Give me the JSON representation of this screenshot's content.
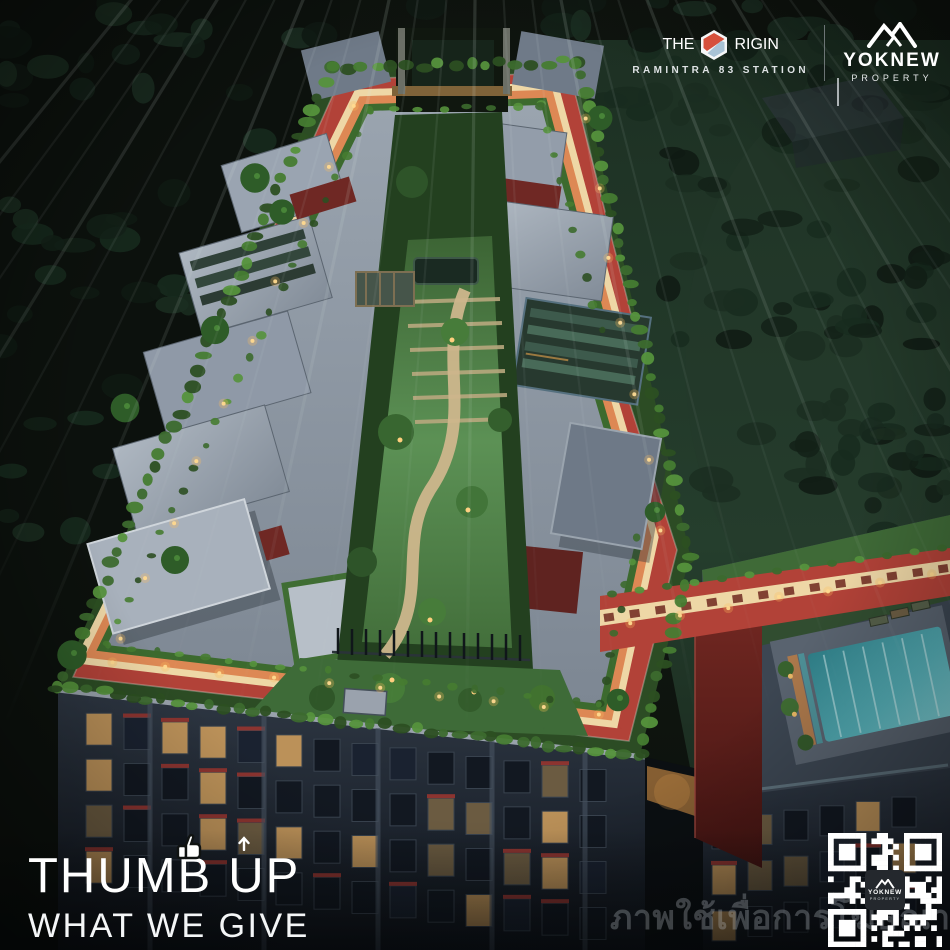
{
  "header": {
    "project": {
      "brand": "THE ORIGIN",
      "name_pre": "THE",
      "name_post": "RIGIN",
      "subtitle": "RAMINTRA 83 STATION"
    },
    "developer": {
      "name": "YOKNEW",
      "division": "PROPERTY"
    }
  },
  "slogan": {
    "line1": "THUMB UP",
    "line1_parts": {
      "a": "THUM",
      "b": "B",
      "c": "UP"
    },
    "line2": "WHAT WE GIVE"
  },
  "watermark": {
    "text": "ภาพใช้เพื่อการโฆษณา"
  },
  "qr_center": {
    "name": "YOKNEW",
    "division": "PROPERTY"
  },
  "colors": {
    "track_red": "#b24238",
    "track_red_deep": "#8f2f28",
    "track_orange": "#dd8854",
    "track_cream": "#eed7a6",
    "hedge_green": "#3c6a2e",
    "hedge_light": "#55923c",
    "lawn_green": "#4f8347",
    "roof_gray": "#929ca8",
    "pool_teal": "#4fa9b0",
    "facade_dark": "#232b36",
    "window_warm": "#c89a5c",
    "window_dim": "#6b5b41",
    "window_dark": "#121821",
    "accent_red": "#8c3430",
    "logo_red": "#d6503c",
    "logo_blue": "#a9c3d6",
    "light_amber": "#ffd98f"
  }
}
